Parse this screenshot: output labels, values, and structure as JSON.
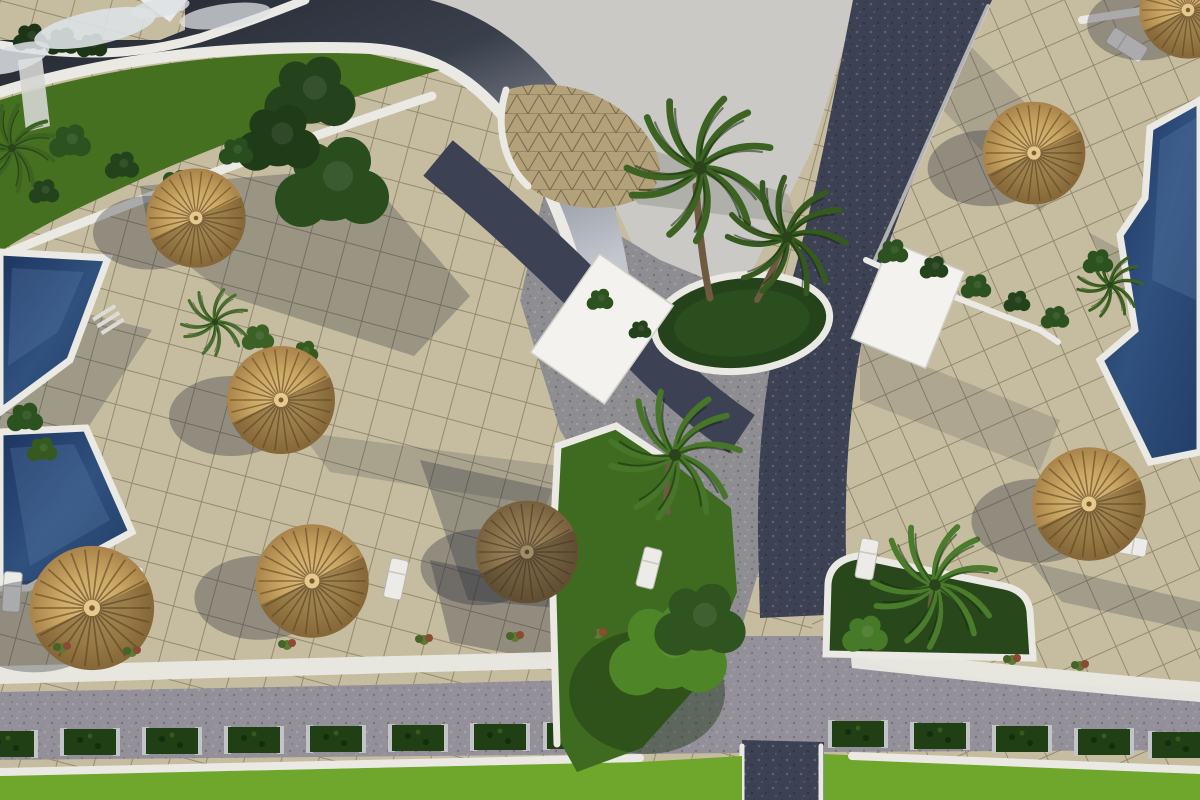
{
  "scene": {
    "title": "Aerial render of resort courtyard",
    "description": "Bird's-eye 3D architectural rendering of a resort courtyard: a curved-roof building with a lattice dome at top, dark asphalt paths crossing beige paved terraces, swimming pools on the left and right edges, straw parasols with white sun loungers, palm trees in round planters, a central lawn island, and a bottom road lined with hedge planter boxes beside a bright green lawn.",
    "palette": {
      "terrace": "#c6bda0",
      "paver-line": "rgba(95,88,62,0.5)",
      "plaza": "#cac9c5",
      "gray-zone": "#8e8d92",
      "road-dark": "#3d4154",
      "road-gray": "#93909a",
      "white": "#eae9e3",
      "pool-deep": "#223e68",
      "pool-light": "#5d7fa8",
      "lawn-top": "#44701f",
      "lawn-tri": "#3e6b1f",
      "lawn-bottom": "#6fa62c",
      "planter-green": "#28481b",
      "hedge": "#203f14",
      "straw": "#c9a763",
      "straw-dark": "#6e5229",
      "canopy": "#f3f2ee",
      "tree-dark": "#24431c",
      "trunk": "#6d5a40",
      "shadow": "#262b3b",
      "lattice": "#b3a179",
      "cloud": "#dde1e4"
    },
    "objects": {
      "umbrellas": [
        {
          "x": 196,
          "y": 218,
          "s": 0.92
        },
        {
          "x": 281,
          "y": 400,
          "s": 1.0
        },
        {
          "x": 92,
          "y": 608,
          "s": 1.15
        },
        {
          "x": 312,
          "y": 581,
          "s": 1.05
        },
        {
          "x": 527,
          "y": 552,
          "s": 0.95,
          "dark": true
        },
        {
          "x": 1034,
          "y": 153,
          "s": 0.95
        },
        {
          "x": 1089,
          "y": 504,
          "s": 1.05
        },
        {
          "x": 1188,
          "y": 10,
          "s": 0.9
        }
      ],
      "palms": [
        {
          "x": 700,
          "y": 168,
          "s": 1.35,
          "rot": -8,
          "c": "#3c6322"
        },
        {
          "x": 787,
          "y": 237,
          "s": 1.1,
          "rot": 14,
          "c": "#35591e"
        },
        {
          "x": 675,
          "y": 455,
          "s": 1.2,
          "rot": 4,
          "c": "#47752a"
        },
        {
          "x": 935,
          "y": 585,
          "s": 1.15,
          "rot": -6,
          "c": "#4a7c2b"
        },
        {
          "x": 12,
          "y": 148,
          "s": 0.8,
          "rot": 25,
          "c": "#3c6322"
        },
        {
          "x": 215,
          "y": 322,
          "s": 0.62,
          "rot": -12,
          "c": "#486f2d"
        },
        {
          "x": 1110,
          "y": 285,
          "s": 0.6,
          "rot": 6,
          "c": "#3c6322"
        }
      ],
      "vegetation": [
        {
          "x": 310,
          "y": 95,
          "s": 2.4,
          "c": "#24431c"
        },
        {
          "x": 332,
          "y": 185,
          "s": 3.0,
          "c": "#2a4d1e"
        },
        {
          "x": 278,
          "y": 140,
          "s": 2.2,
          "c": "#1f3b17"
        },
        {
          "x": 668,
          "y": 652,
          "s": 3.1,
          "c": "#4e8526"
        },
        {
          "x": 700,
          "y": 622,
          "s": 2.4,
          "c": "#2f5420"
        },
        {
          "x": 70,
          "y": 142,
          "s": 1.1,
          "c": "#2c5220"
        },
        {
          "x": 122,
          "y": 166,
          "s": 0.9,
          "c": "#24431c"
        },
        {
          "x": 176,
          "y": 186,
          "s": 1.0,
          "c": "#2c5220"
        },
        {
          "x": 44,
          "y": 192,
          "s": 0.8,
          "c": "#24431c"
        },
        {
          "x": 236,
          "y": 152,
          "s": 0.9,
          "c": "#2a4d1e"
        },
        {
          "x": 30,
          "y": 38,
          "s": 0.9,
          "c": "#1c3517"
        },
        {
          "x": 62,
          "y": 42,
          "s": 0.9,
          "c": "#1c3517"
        },
        {
          "x": 92,
          "y": 46,
          "s": 0.8,
          "c": "#1c3517"
        },
        {
          "x": 893,
          "y": 252,
          "s": 0.8,
          "c": "#2c5220"
        },
        {
          "x": 934,
          "y": 268,
          "s": 0.75,
          "c": "#24431c"
        },
        {
          "x": 976,
          "y": 287,
          "s": 0.8,
          "c": "#2c5220"
        },
        {
          "x": 1017,
          "y": 302,
          "s": 0.7,
          "c": "#24431c"
        },
        {
          "x": 1055,
          "y": 318,
          "s": 0.75,
          "c": "#2c5220"
        },
        {
          "x": 258,
          "y": 338,
          "s": 0.85,
          "c": "#3c6125"
        },
        {
          "x": 305,
          "y": 352,
          "s": 0.7,
          "c": "#35591e"
        },
        {
          "x": 25,
          "y": 418,
          "s": 0.95,
          "c": "#2c5220"
        },
        {
          "x": 42,
          "y": 450,
          "s": 0.8,
          "c": "#35591e"
        },
        {
          "x": 1098,
          "y": 262,
          "s": 0.8,
          "c": "#2c5220"
        },
        {
          "x": 865,
          "y": 635,
          "s": 1.2,
          "c": "#477a28"
        },
        {
          "x": 600,
          "y": 300,
          "s": 0.7,
          "c": "#2c5220"
        },
        {
          "x": 640,
          "y": 330,
          "s": 0.6,
          "c": "#24431c"
        }
      ],
      "loungers": [
        {
          "x": 12,
          "y": 592,
          "rot": 4
        },
        {
          "x": 132,
          "y": 586,
          "rot": 8
        },
        {
          "x": 396,
          "y": 579,
          "rot": 12
        },
        {
          "x": 649,
          "y": 568,
          "rot": 14
        },
        {
          "x": 867,
          "y": 559,
          "rot": 10
        },
        {
          "x": 1103,
          "y": 529,
          "rot": 100
        },
        {
          "x": 1127,
          "y": 545,
          "rot": 100
        },
        {
          "x": 1127,
          "y": 45,
          "rot": -58
        }
      ],
      "hedges": [
        {
          "x": 8,
          "y": 744
        },
        {
          "x": 90,
          "y": 742
        },
        {
          "x": 172,
          "y": 741
        },
        {
          "x": 254,
          "y": 740
        },
        {
          "x": 336,
          "y": 739
        },
        {
          "x": 418,
          "y": 738
        },
        {
          "x": 500,
          "y": 737
        },
        {
          "x": 573,
          "y": 736
        },
        {
          "x": 858,
          "y": 734
        },
        {
          "x": 940,
          "y": 736
        },
        {
          "x": 1022,
          "y": 739
        },
        {
          "x": 1104,
          "y": 742
        },
        {
          "x": 1178,
          "y": 745
        }
      ],
      "flowers": [
        {
          "x": 62,
          "y": 648
        },
        {
          "x": 132,
          "y": 652
        },
        {
          "x": 287,
          "y": 645
        },
        {
          "x": 424,
          "y": 640
        },
        {
          "x": 515,
          "y": 637
        },
        {
          "x": 598,
          "y": 634
        },
        {
          "x": 1012,
          "y": 660
        },
        {
          "x": 1080,
          "y": 666
        }
      ],
      "clouds": [
        {
          "x": 95,
          "y": 28,
          "rx": 62,
          "ry": 17,
          "rot": -12,
          "op": 0.9
        },
        {
          "x": 225,
          "y": 16,
          "rx": 46,
          "ry": 12,
          "rot": -8,
          "op": 0.75
        },
        {
          "x": 15,
          "y": 58,
          "rx": 36,
          "ry": 13,
          "rot": -18,
          "op": 0.85
        },
        {
          "x": 160,
          "y": 8,
          "rx": 30,
          "ry": 9,
          "rot": -10,
          "op": 0.8
        }
      ]
    }
  }
}
